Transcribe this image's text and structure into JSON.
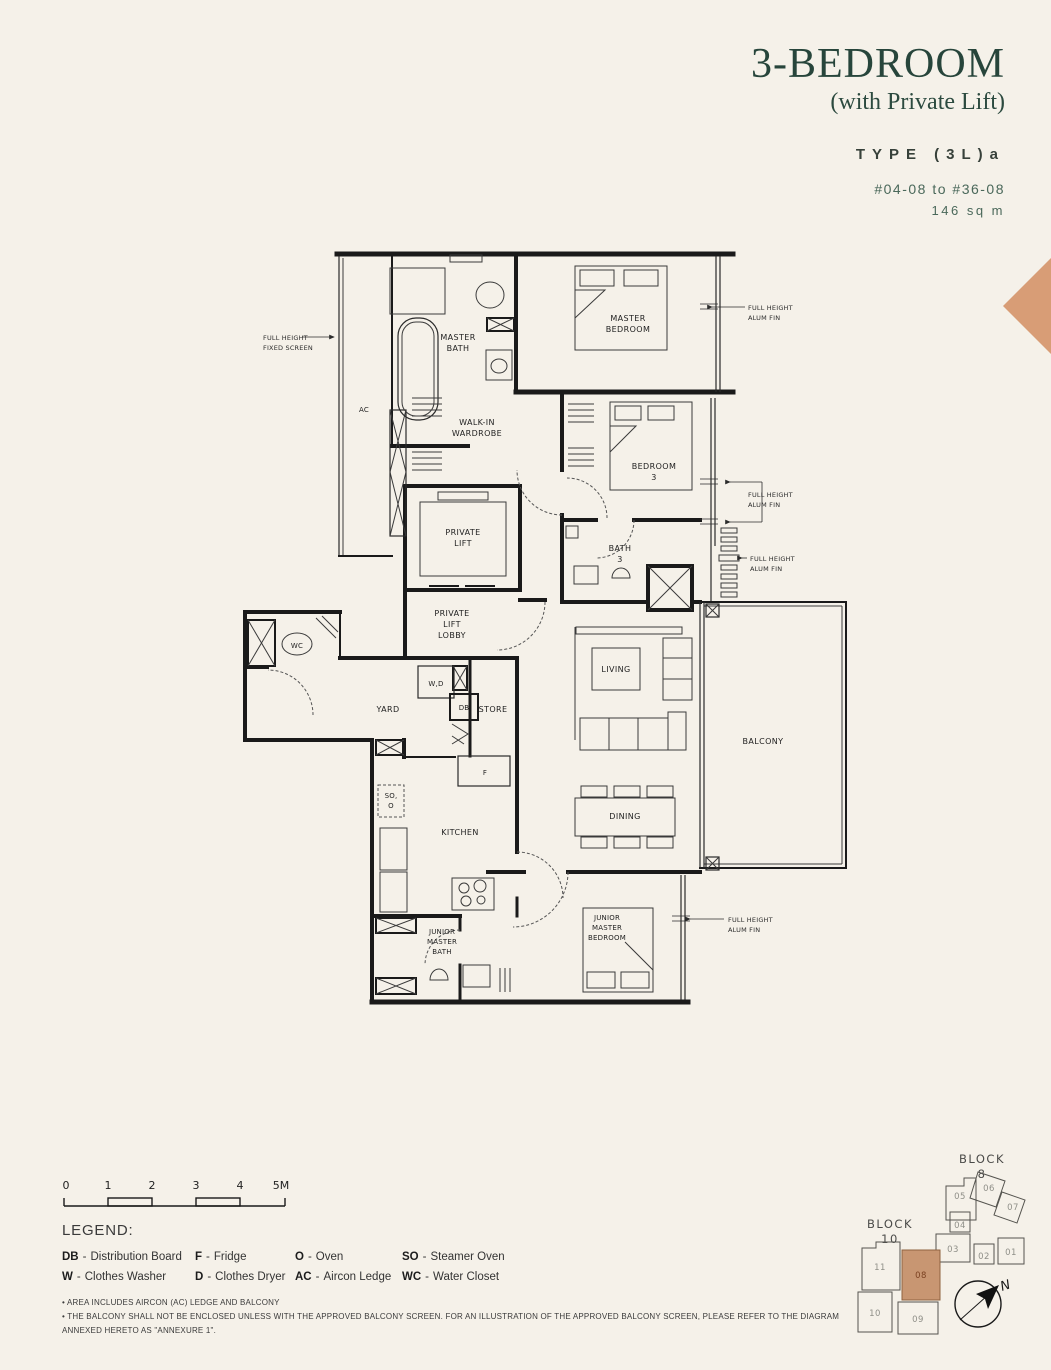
{
  "header": {
    "title": "3-BEDROOM",
    "subtitle": "(with Private Lift)",
    "type_label": "TYPE (3L)a",
    "units_range": "#04-08 to #36-08",
    "area": "146 sq m"
  },
  "colors": {
    "title_green": "#27453b",
    "accent_tan": "#d89d76",
    "wall_black": "#1a1a1a",
    "background": "#f5f1e9",
    "highlight_unit_fill": "#c89672"
  },
  "plan": {
    "rooms": {
      "master_bath": [
        "MASTER",
        "BATH"
      ],
      "master_bedroom": [
        "MASTER",
        "BEDROOM"
      ],
      "walk_in_wardrobe": [
        "WALK-IN",
        "WARDROBE"
      ],
      "bedroom3": [
        "BEDROOM",
        "3"
      ],
      "private_lift": [
        "PRIVATE",
        "LIFT"
      ],
      "bath3": [
        "BATH",
        "3"
      ],
      "private_lift_lobby": [
        "PRIVATE",
        "LIFT",
        "LOBBY"
      ],
      "wc": "WC",
      "yard": "YARD",
      "wd": "W,D",
      "db": "DB",
      "store": "STORE",
      "fridge": "F",
      "steamer_oven": "SO,",
      "oven": "O",
      "kitchen": "KITCHEN",
      "living": "LIVING",
      "dining": "DINING",
      "balcony": "BALCONY",
      "junior_master_bath": [
        "JUNIOR",
        "MASTER",
        "BATH"
      ],
      "junior_master_bedroom": [
        "JUNIOR",
        "MASTER",
        "BEDROOM"
      ],
      "ac": "AC"
    },
    "annotations": {
      "fixed_screen": [
        "FULL HEIGHT",
        "FIXED SCREEN"
      ],
      "alum_fin": [
        "FULL HEIGHT",
        "ALUM FIN"
      ]
    }
  },
  "scale": {
    "ticks": [
      "0",
      "1",
      "2",
      "3",
      "4",
      "5M"
    ]
  },
  "legend": {
    "heading": "LEGEND:",
    "separator": "-",
    "items": [
      {
        "abbr": "DB",
        "label": "Distribution Board"
      },
      {
        "abbr": "F",
        "label": "Fridge"
      },
      {
        "abbr": "O",
        "label": "Oven"
      },
      {
        "abbr": "SO",
        "label": "Steamer Oven"
      },
      {
        "abbr": "W",
        "label": "Clothes Washer"
      },
      {
        "abbr": "D",
        "label": "Clothes Dryer"
      },
      {
        "abbr": "AC",
        "label": "Aircon Ledge"
      },
      {
        "abbr": "WC",
        "label": "Water Closet"
      }
    ]
  },
  "footnotes": [
    "• AREA INCLUDES AIRCON (AC) LEDGE AND BALCONY",
    "• THE BALCONY SHALL NOT BE ENCLOSED UNLESS WITH THE APPROVED BALCONY SCREEN. FOR AN ILLUSTRATION OF THE APPROVED BALCONY SCREEN, PLEASE REFER TO THE DIAGRAM ANNEXED HERETO AS \"ANNEXURE 1\"."
  ],
  "keyplan": {
    "block8": {
      "label": [
        "BLOCK",
        "8"
      ],
      "units": [
        "05",
        "06",
        "07",
        "04",
        "03",
        "02",
        "01"
      ]
    },
    "block10": {
      "label": [
        "BLOCK",
        "10"
      ],
      "units": [
        "11",
        "08",
        "10",
        "09"
      ],
      "highlighted_unit": "08"
    },
    "north_label": "N"
  }
}
